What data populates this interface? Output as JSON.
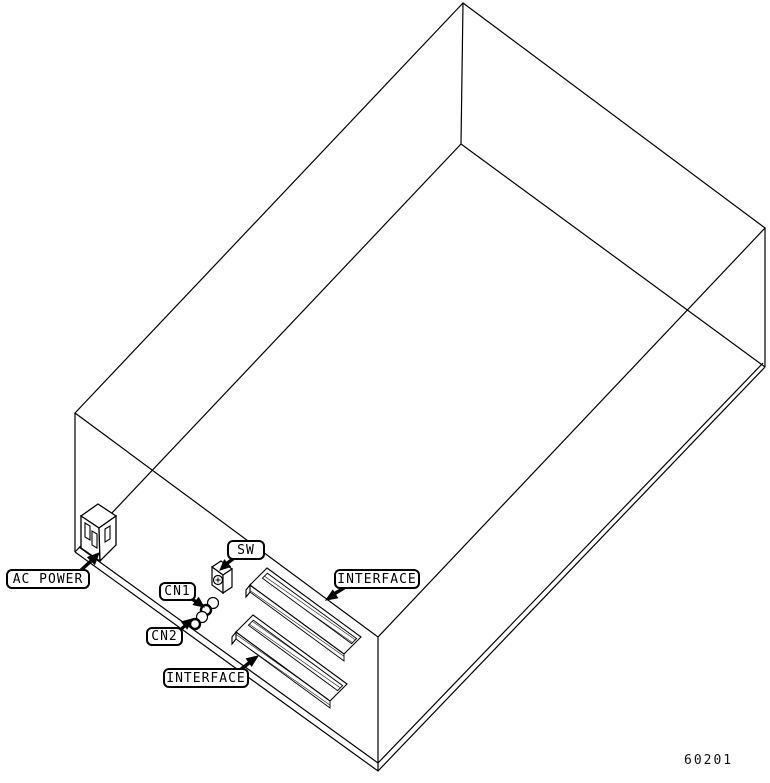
{
  "diagram": {
    "type": "isometric-rear-panel-wireframe",
    "figure_number": "60201",
    "labels": {
      "ac_power": "AC POWER",
      "sw": "SW",
      "cn1": "CN1",
      "cn2": "CN2",
      "interface_top": "INTERFACE",
      "interface_bottom": "INTERFACE"
    },
    "colors": {
      "line": "#000000",
      "background": "#ffffff"
    }
  }
}
